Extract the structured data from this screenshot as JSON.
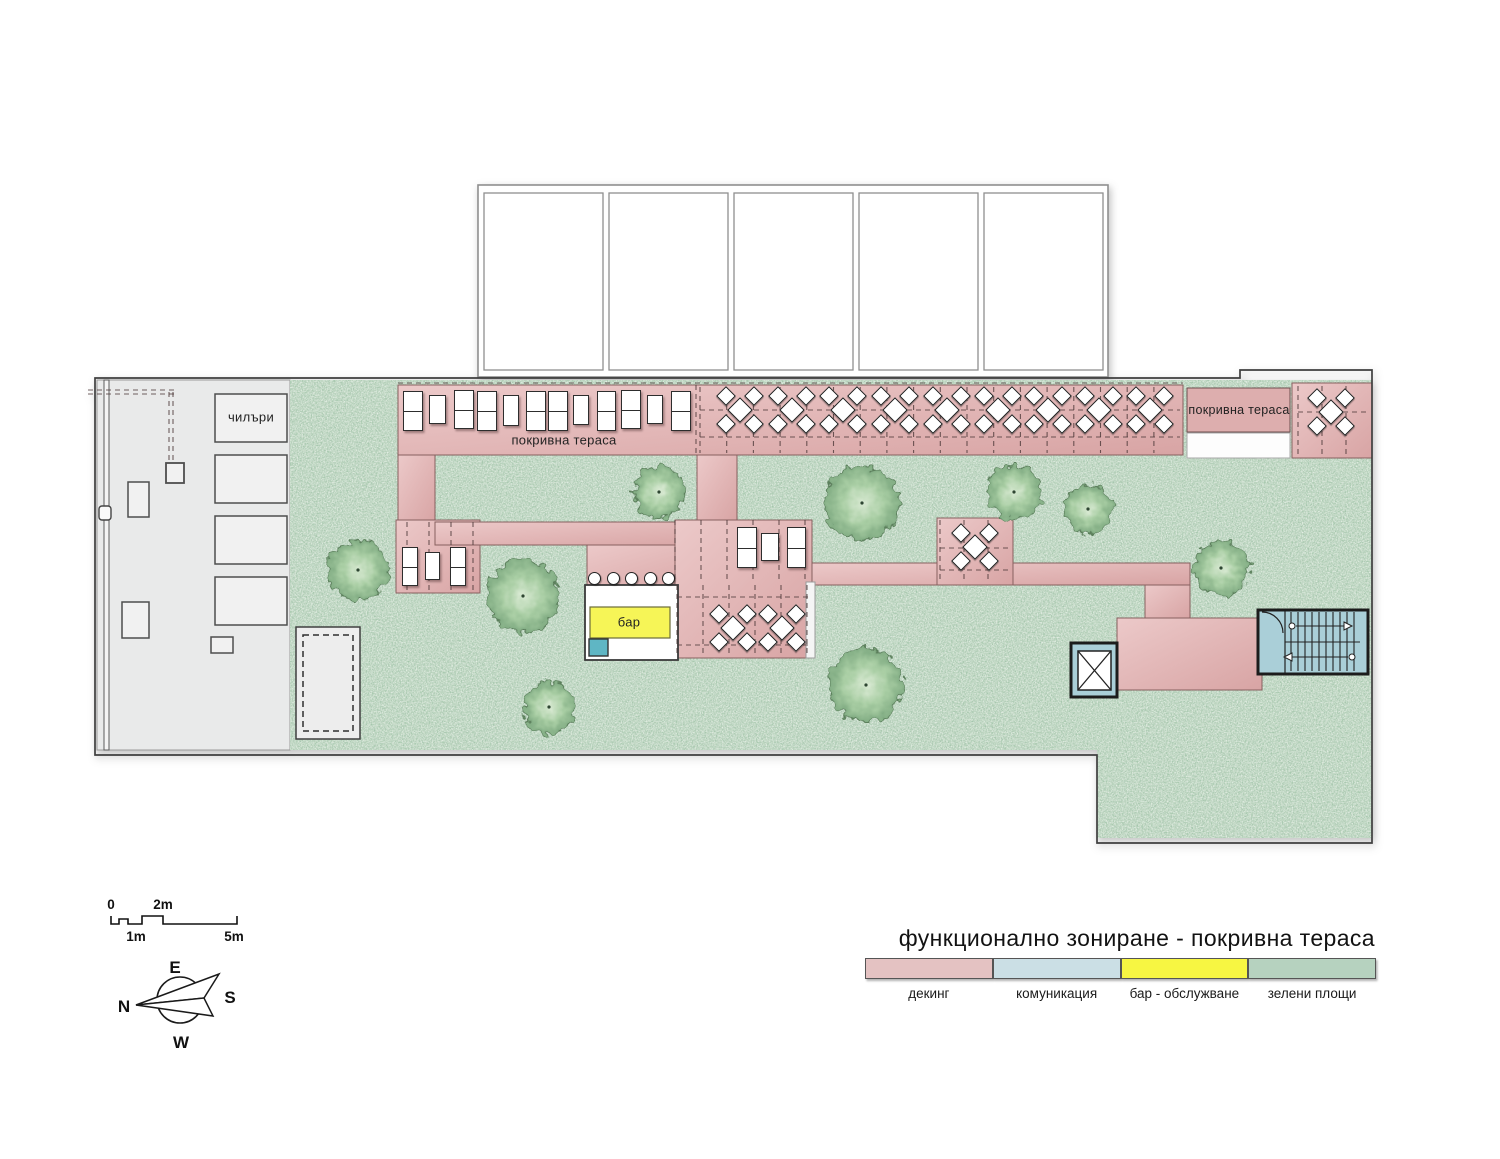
{
  "title": "функционално зониране - покривна тераса",
  "legend": {
    "items": [
      {
        "label": "декинг",
        "color": "#e4c2c2"
      },
      {
        "label": "комуникация",
        "color": "#cbdfe5"
      },
      {
        "label": "бар - обслужване",
        "color": "#f7f642"
      },
      {
        "label": "зелени площи",
        "color": "#b6d2bf"
      }
    ]
  },
  "plan_labels": {
    "chillers": "чилъри",
    "roof_terrace_top": "покривна тераса",
    "roof_terrace_right": "покривна тераса",
    "bar": "бар"
  },
  "scale_bar": {
    "zero": "0",
    "two": "2m",
    "one": "1m",
    "five": "5m"
  },
  "compass": {
    "n": "N",
    "e": "E",
    "s": "S",
    "w": "W"
  },
  "colors": {
    "deck": "#e0b4b4",
    "communication": "#aacfd8",
    "bar_service": "#f6f557",
    "green": "#c6dbc8",
    "service_gray": "#e9eaea"
  },
  "plan": {
    "loungers": [
      {
        "x": 403,
        "y": 391,
        "w": 20,
        "h": 40,
        "d": 1
      },
      {
        "x": 429,
        "y": 395,
        "w": 17,
        "h": 29,
        "d": 0
      },
      {
        "x": 454,
        "y": 390,
        "w": 20,
        "h": 39,
        "d": 1
      },
      {
        "x": 477,
        "y": 391,
        "w": 20,
        "h": 40,
        "d": 1
      },
      {
        "x": 503,
        "y": 395,
        "w": 16,
        "h": 31,
        "d": 0
      },
      {
        "x": 526,
        "y": 391,
        "w": 20,
        "h": 40,
        "d": 1
      },
      {
        "x": 548,
        "y": 391,
        "w": 20,
        "h": 40,
        "d": 1
      },
      {
        "x": 573,
        "y": 395,
        "w": 16,
        "h": 30,
        "d": 0
      },
      {
        "x": 597,
        "y": 391,
        "w": 19,
        "h": 40,
        "d": 1
      },
      {
        "x": 621,
        "y": 390,
        "w": 20,
        "h": 39,
        "d": 1
      },
      {
        "x": 647,
        "y": 395,
        "w": 16,
        "h": 29,
        "d": 0
      },
      {
        "x": 671,
        "y": 391,
        "w": 20,
        "h": 40,
        "d": 1
      },
      {
        "x": 402,
        "y": 547,
        "w": 16,
        "h": 39,
        "d": 1
      },
      {
        "x": 425,
        "y": 552,
        "w": 15,
        "h": 28,
        "d": 0
      },
      {
        "x": 450,
        "y": 547,
        "w": 16,
        "h": 39,
        "d": 1
      },
      {
        "x": 737,
        "y": 527,
        "w": 20,
        "h": 41,
        "d": 1
      },
      {
        "x": 761,
        "y": 533,
        "w": 18,
        "h": 28,
        "d": 0
      },
      {
        "x": 787,
        "y": 527,
        "w": 19,
        "h": 41,
        "d": 1
      }
    ],
    "tables": [
      {
        "cx": 740,
        "cy": 410
      },
      {
        "cx": 792,
        "cy": 410
      },
      {
        "cx": 843,
        "cy": 410
      },
      {
        "cx": 895,
        "cy": 410
      },
      {
        "cx": 947,
        "cy": 410
      },
      {
        "cx": 998,
        "cy": 410
      },
      {
        "cx": 1048,
        "cy": 410
      },
      {
        "cx": 1099,
        "cy": 410
      },
      {
        "cx": 1150,
        "cy": 410
      },
      {
        "cx": 1331,
        "cy": 412
      },
      {
        "cx": 975,
        "cy": 547
      },
      {
        "cx": 733,
        "cy": 628
      },
      {
        "cx": 782,
        "cy": 628
      }
    ],
    "stools": [
      {
        "cx": 594,
        "cy": 578
      },
      {
        "cx": 613,
        "cy": 578
      },
      {
        "cx": 631,
        "cy": 578
      },
      {
        "cx": 650,
        "cy": 578
      },
      {
        "cx": 668,
        "cy": 578
      }
    ],
    "grids": [
      {
        "x1": 700,
        "x2": 1180,
        "y1": 387,
        "y2": 453,
        "vstep": 26.7,
        "hlines": [
          410,
          437
        ]
      },
      {
        "x1": 696,
        "x2": 696,
        "y1": 385,
        "y2": 455,
        "vstep": 9,
        "hlines": []
      },
      {
        "x1": 1298,
        "x2": 1368,
        "y1": 386,
        "y2": 455,
        "vstep": 24,
        "hlines": [
          412
        ]
      },
      {
        "x1": 677,
        "x2": 808,
        "y1": 585,
        "y2": 654,
        "vstep": 26,
        "hlines": [
          597,
          645
        ]
      },
      {
        "x1": 675,
        "x2": 810,
        "y1": 520,
        "y2": 583,
        "vstep": 26,
        "hlines": []
      },
      {
        "x1": 940,
        "x2": 1011,
        "y1": 520,
        "y2": 583,
        "vstep": 24,
        "hlines": [
          548,
          570
        ]
      },
      {
        "x1": 407,
        "x2": 473,
        "y1": 522,
        "y2": 590,
        "vstep": 22,
        "hlines": []
      },
      {
        "x1": 88,
        "x2": 176,
        "y1": 390,
        "y2": 394,
        "vstep": 0,
        "hlines": [
          390,
          394
        ]
      },
      {
        "x1": 169,
        "x2": 173,
        "y1": 392,
        "y2": 463,
        "vstep": 4,
        "hlines": []
      },
      {
        "x1": 398,
        "x2": 1183,
        "y1": 383,
        "y2": 383,
        "vstep": 0,
        "hlines": [
          383
        ]
      }
    ]
  }
}
